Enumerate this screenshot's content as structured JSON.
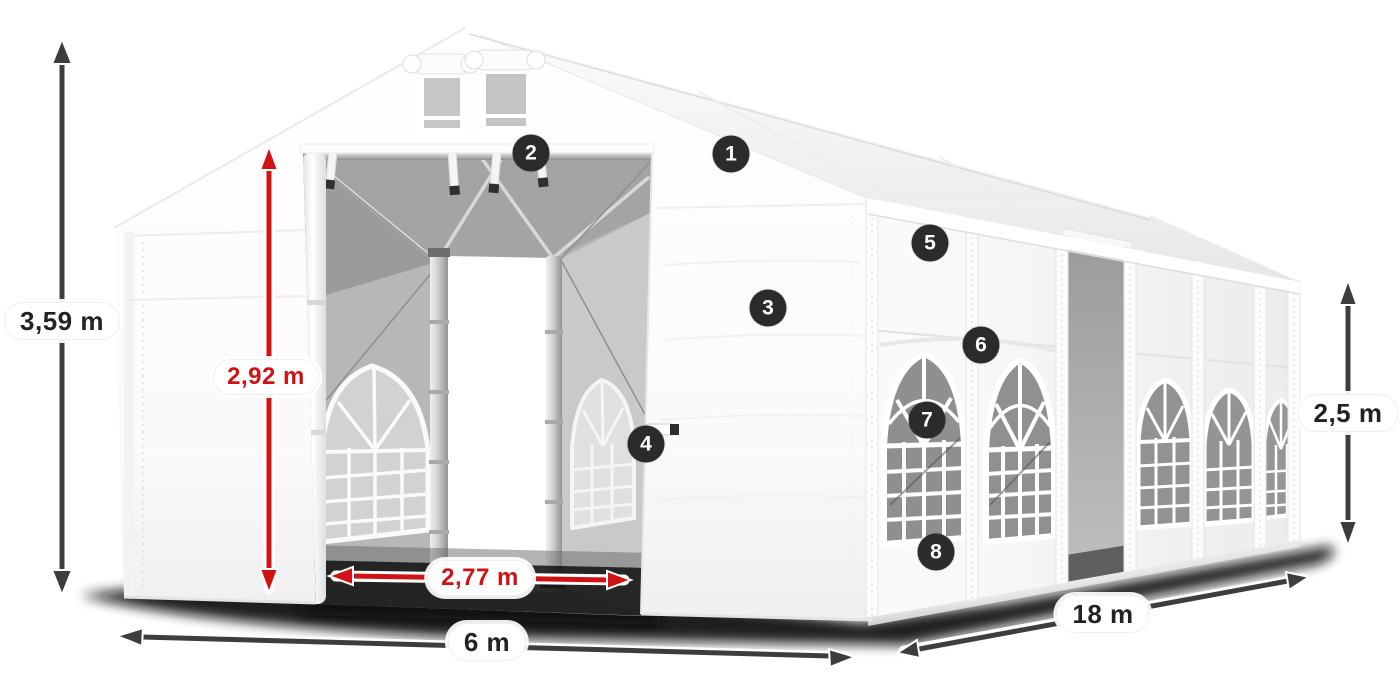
{
  "figure": {
    "description": "Dimension diagram of a white marquee tent shown in perspective with open front doors"
  },
  "measurements": [
    {
      "id": "total-height",
      "value": "3,59 m",
      "color": "#222222"
    },
    {
      "id": "door-height",
      "value": "2,92 m",
      "color": "#cf1315"
    },
    {
      "id": "door-width",
      "value": "2,77 m",
      "color": "#cf1315"
    },
    {
      "id": "base-width",
      "value": "6 m",
      "color": "#222222"
    },
    {
      "id": "length",
      "value": "18 m",
      "color": "#222222"
    },
    {
      "id": "side-height",
      "value": "2,5 m",
      "color": "#222222"
    }
  ],
  "callouts": [
    {
      "number": "1"
    },
    {
      "number": "2"
    },
    {
      "number": "3"
    },
    {
      "number": "4"
    },
    {
      "number": "5"
    },
    {
      "number": "6"
    },
    {
      "number": "7"
    },
    {
      "number": "8"
    }
  ],
  "colors": {
    "arrow_dark": "#3d3d3d",
    "accent_red": "#cf1315",
    "badge_bg": "#2b2b2b",
    "label_text": "#222222"
  }
}
